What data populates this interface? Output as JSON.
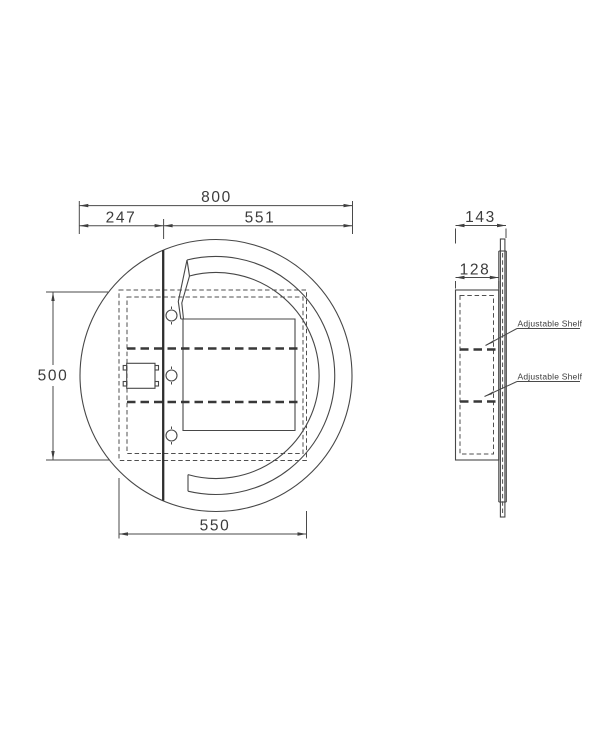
{
  "drawing": {
    "title": "round-mirror-cabinet-technical-drawing",
    "front_view": {
      "dims": {
        "overall_width": "800",
        "hinge_offset_left": "247",
        "door_span_right": "551",
        "cabinet_height": "500",
        "cabinet_width": "550"
      }
    },
    "side_view": {
      "dims": {
        "overall_depth": "143",
        "cabinet_depth": "128"
      },
      "labels": {
        "shelf_1": "Adjustable Shelf",
        "shelf_2": "Adjustable Shelf"
      }
    },
    "colors": {
      "line": "#474747",
      "bold_line": "#2e2e2e",
      "dimension": "#4a4a4a",
      "text": "#3c3c3c",
      "background": "#ffffff"
    }
  }
}
